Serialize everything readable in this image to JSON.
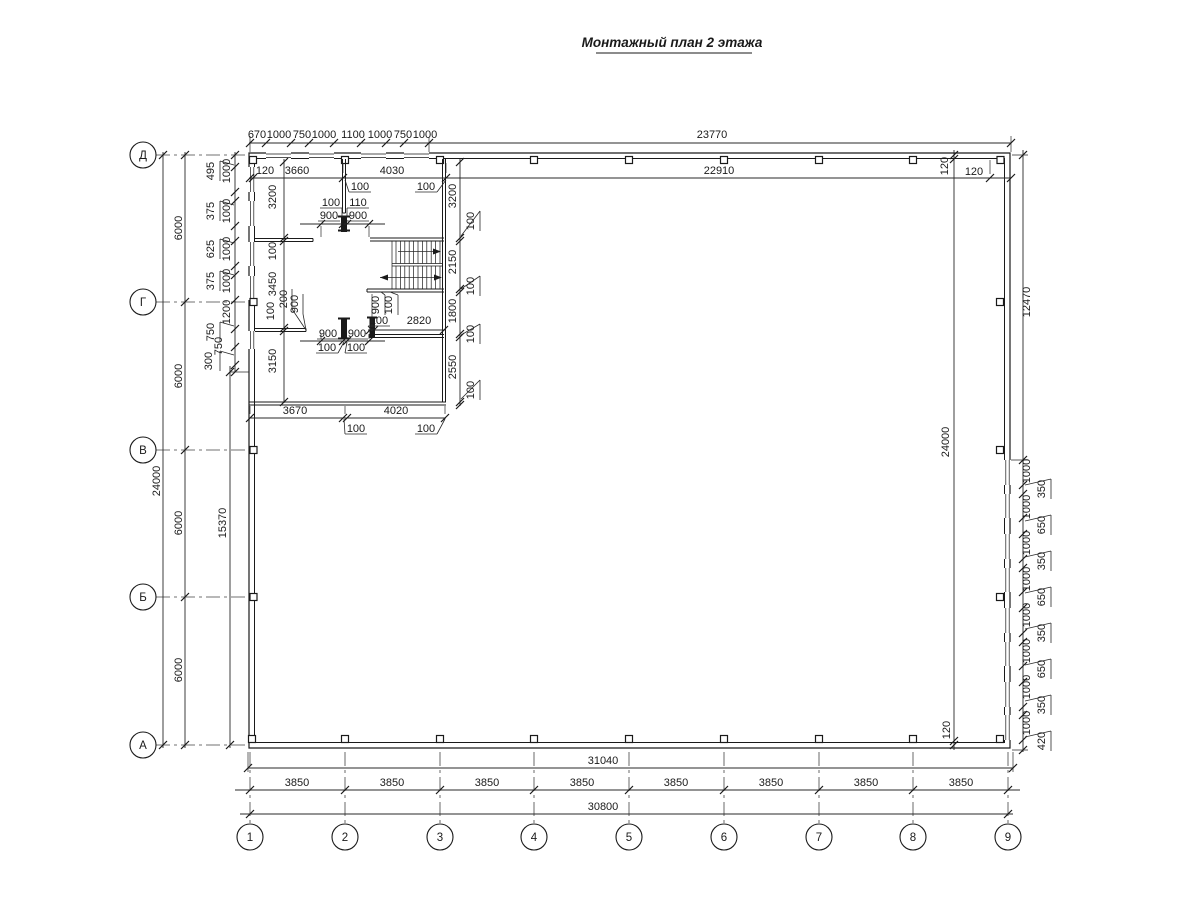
{
  "title": "Монтажный план 2 этажа",
  "axes": {
    "rows": [
      "Д",
      "Г",
      "В",
      "Б",
      "А"
    ],
    "cols": [
      "1",
      "2",
      "3",
      "4",
      "5",
      "6",
      "7",
      "8",
      "9"
    ]
  },
  "dims": {
    "topChain": [
      "670",
      "1000",
      "750",
      "1000",
      "1100",
      "1000",
      "750",
      "1000"
    ],
    "topTotal": "23770",
    "row2": [
      "120",
      "3660",
      "4030",
      "22910"
    ],
    "rightWall120": [
      "120",
      "120",
      "120"
    ],
    "topLeaders": [
      "100",
      "100"
    ],
    "doorTop": [
      "100",
      "110",
      "900",
      "900"
    ],
    "leftWinLeaders": [
      "495",
      "375",
      "625",
      "375",
      "750",
      "300"
    ],
    "leftWinInline": [
      "1000",
      "1000",
      "1000",
      "1000",
      "1200",
      "750"
    ],
    "leftRoom": [
      "3200",
      "100",
      "3450",
      "100",
      "3150"
    ],
    "leftDoor": [
      "200",
      "900"
    ],
    "rightRoom": [
      "3200",
      "2150",
      "1800",
      "2550"
    ],
    "rightRoomLeaders": [
      "100",
      "100",
      "100",
      "100"
    ],
    "stairLeaders": [
      "900",
      "100"
    ],
    "midRow": [
      "100",
      "2820"
    ],
    "doorMid": [
      "900",
      "900",
      "100",
      "100"
    ],
    "blockBottom": [
      "3670",
      "4020"
    ],
    "blockBottomLeaders": [
      "100",
      "100"
    ],
    "leftSpans": [
      "6000",
      "6000",
      "6000",
      "6000"
    ],
    "leftTotal": "24000",
    "left15370": "15370",
    "right24000": "24000",
    "right12470": "12470",
    "rightChain": [
      "1000",
      "1000",
      "1000",
      "1000",
      "1000",
      "1000",
      "1000",
      "1000"
    ],
    "rightChainLeaders": [
      "350",
      "650",
      "350",
      "650",
      "350",
      "650",
      "350",
      "420"
    ],
    "bottom31040": "31040",
    "bottomBays": [
      "3850",
      "3850",
      "3850",
      "3850",
      "3850",
      "3850",
      "3850",
      "3850"
    ],
    "bottom30800": "30800"
  }
}
